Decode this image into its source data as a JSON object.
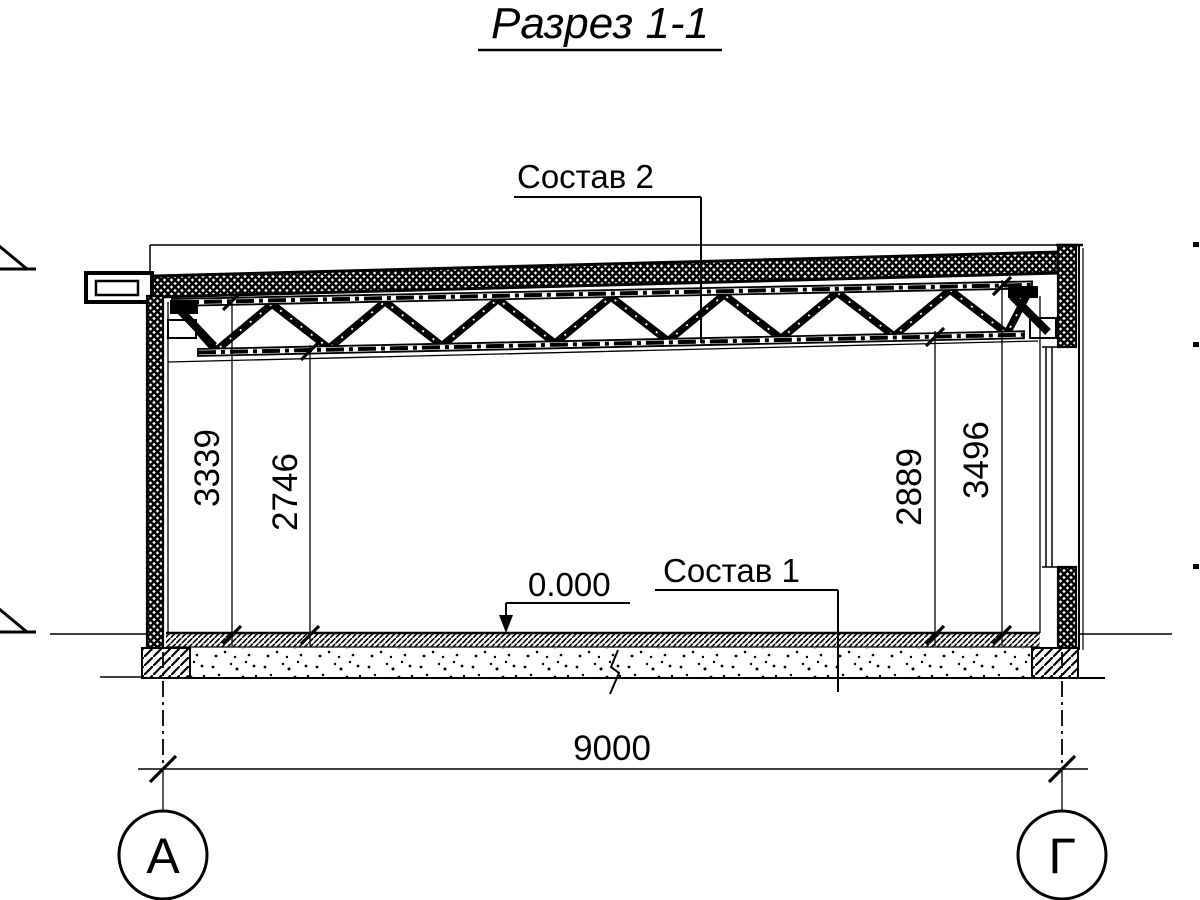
{
  "drawing": {
    "title": "Разрез 1-1",
    "callouts": {
      "roof_assembly": "Состав 2",
      "floor_assembly": "Состав 1"
    },
    "elevation_mark": "0.000",
    "dimensions": {
      "left_to_top_chord": "3339",
      "left_to_bottom_chord": "2746",
      "right_to_bottom_chord": "2889",
      "right_to_top_chord": "3496",
      "span": "9000"
    },
    "axis_markers": {
      "left": "А",
      "right": "Г"
    },
    "colors": {
      "ink": "#000000",
      "paper": "#ffffff"
    }
  }
}
